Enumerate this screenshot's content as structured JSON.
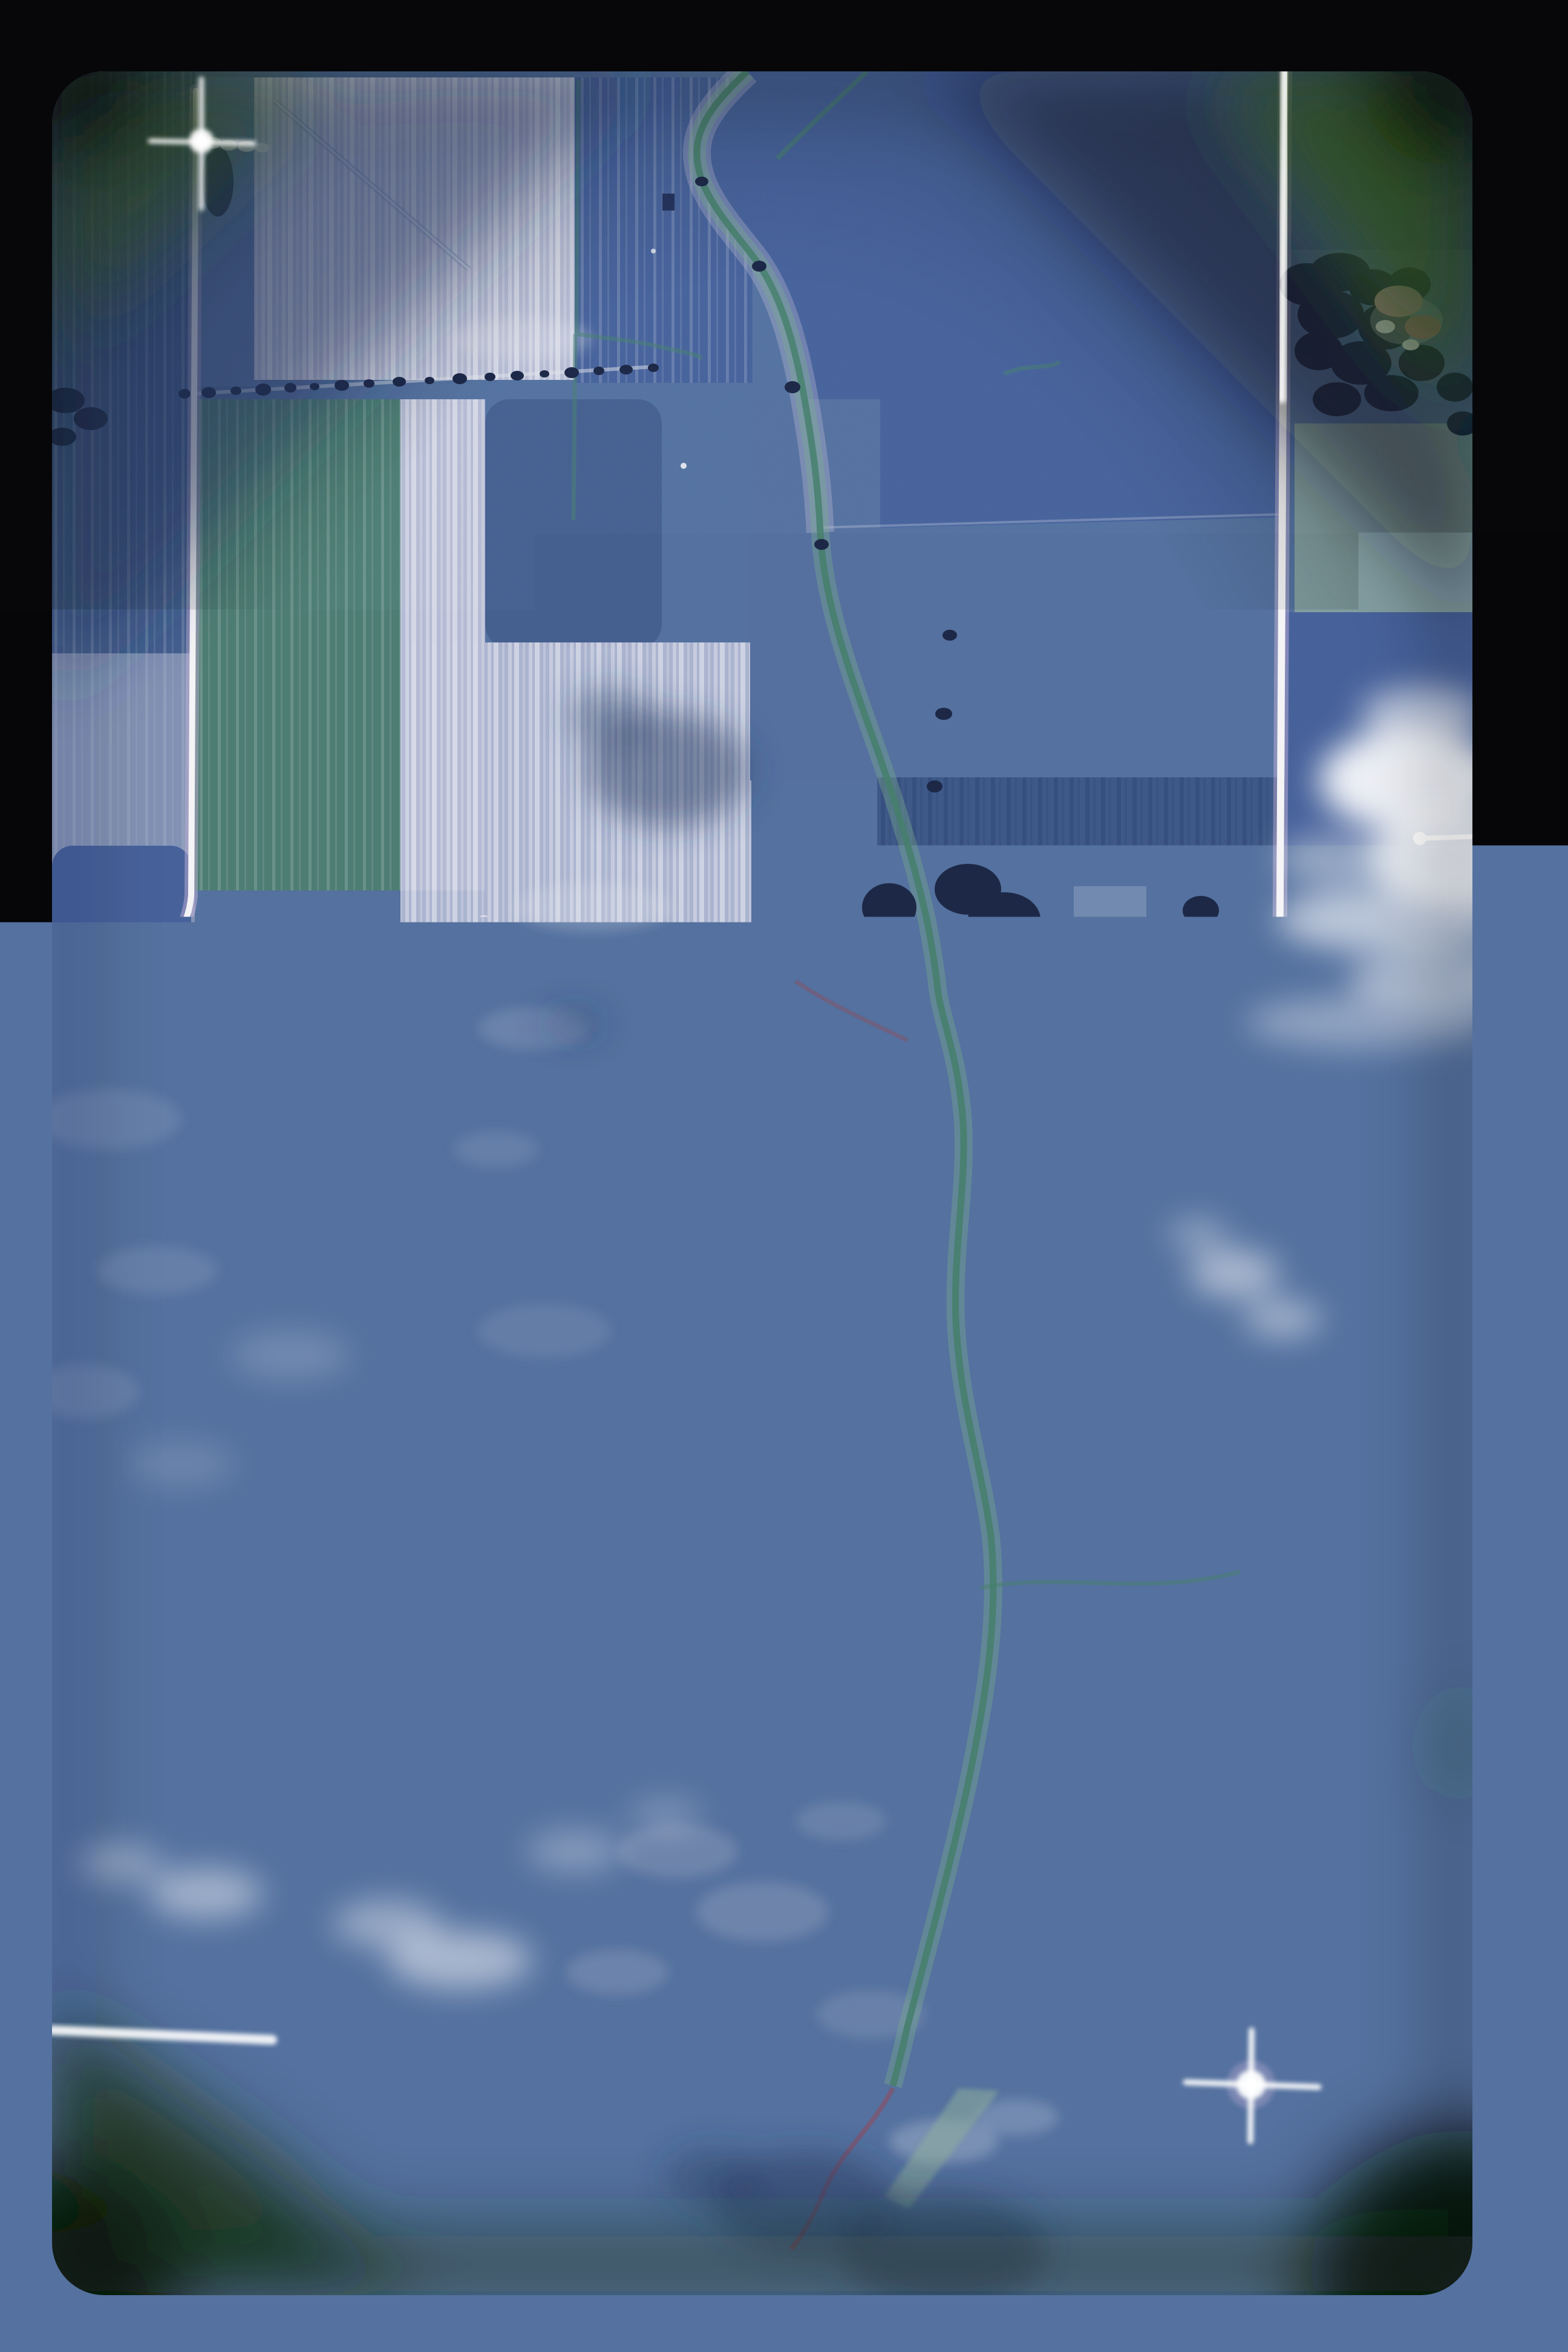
{
  "photo": {
    "kind": "aerial-photograph-slide",
    "alt": "Vertical aerial photograph of agricultural fields viewed through a slide with dark rounded-corner vignette: section roads in a grid, a meandering creek, a three-cell waste lagoon, scattered farmsteads, woodlots and small cumulus clouds with shadows",
    "orientation": "portrait",
    "palette": {
      "frameBlack": "#060609",
      "photoBase": "#54719f",
      "fieldBlue": "#55709f",
      "fieldBlueSoft": "#5e7aa8",
      "fieldBlueDeep": "#47629b",
      "fieldBlueDark": "#3e5988",
      "fieldIndigo": "#45608f",
      "fieldPale": "#b5bbd4",
      "fieldPaleBright": "#e6e7ef",
      "fieldSteel": "#7d92b8",
      "fieldTeal": "#4e7d74",
      "fieldTealSoft": "#8ba5a0",
      "fieldSage": "#a4b8a6",
      "fieldSageDeep": "#8fae9c",
      "fieldGreenPale": "#96ab80",
      "fieldGreenMint": "#9cc0a8",
      "fieldGray": "#8e94a9",
      "fieldLavender": "#a29ec2",
      "roadWhite": "#f4f3f6",
      "roadHalo": "#cdb9dc",
      "roadMagenta": "#9a7fae",
      "treeNavy": "#1d2847",
      "treeNavyDeep": "#141d36",
      "creekTeal": "#47806e",
      "creekBank": "#79a98d",
      "creekSand": "#c9c4da",
      "creekRed": "#7e5670",
      "pondNavy": "#1d2c5e",
      "pondNavyDeep": "#20336b",
      "pondMauve": "#6b6387",
      "pondCyan": "#aee0dc",
      "pondRim": "#e9edf3",
      "padTeal": "#4f8a72",
      "padRim": "#7fae96",
      "cloudWhite": "#ffffff",
      "cloudShadow": "#2b3d63",
      "farmWhite": "#f0f0f4",
      "farmPink": "#c9a3b4",
      "farmRed": "#9c5a52",
      "vigGreen": "#2f511a",
      "vigGreenDeep": "#1c380e",
      "vigGreenBlack": "#0d2208",
      "vigSlate": "#26345c",
      "vigInk": "#0d1724",
      "ditchFill": "#bcd8ca",
      "ditchDot": "#2c3a60"
    },
    "features": {
      "film": [
        "black slide frame",
        "rounded-corner image window",
        "green corner vignette",
        "lens flares on roads",
        "film grain",
        "dust specks"
      ],
      "roads": [
        "east-west section road across middle",
        "north road curving west at corner",
        "north-south road along right side",
        "east-west road near bottom",
        "lagoon access lane",
        "field access lanes and boundary tracks"
      ],
      "water": [
        "meandering creek from top center to bottom center",
        "grassed waterways",
        "field drainage ditch with round basin",
        "three-cell rectangular lagoon (dark, mauve, dark-with-algae)"
      ],
      "landcover": [
        "striped row-crop fields",
        "pale fallow and cut fields",
        "teal-green pasture",
        "gray tilled block",
        "dense woodlot in lower left",
        "hedgerows and shelterbelts"
      ],
      "structures": [
        "farmstead with pink barn at left of center",
        "farmstead with white barns below main road",
        "farmstead east of right road with red roofs",
        "farmstead in upper right woodlot",
        "white farm buildings near bottom road"
      ],
      "atmosphere": [
        "small cumulus clouds on right and lower left",
        "cloud shadows on fields"
      ]
    }
  }
}
